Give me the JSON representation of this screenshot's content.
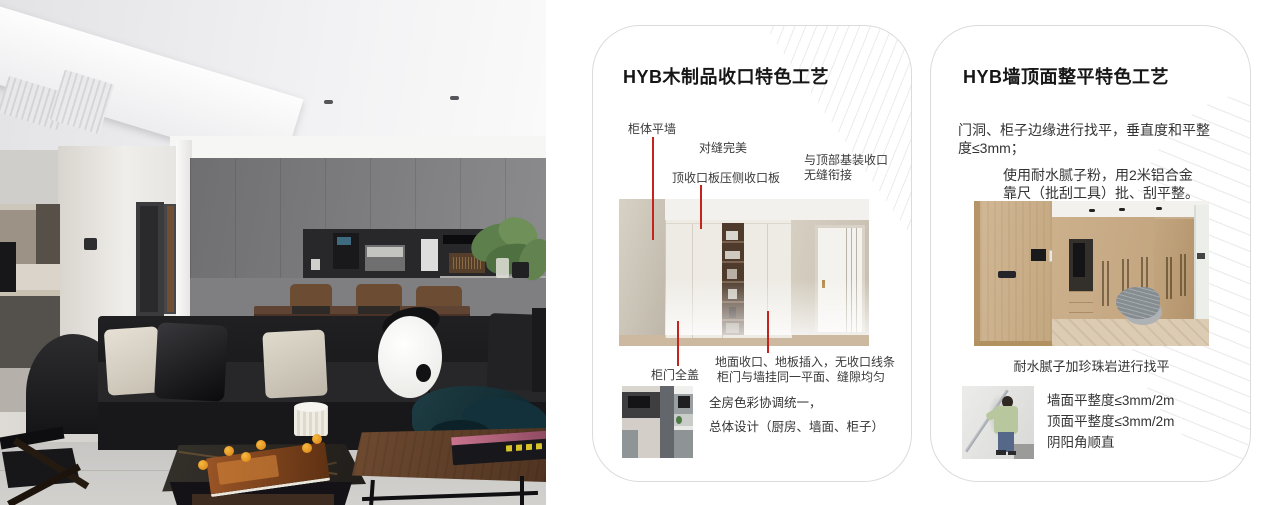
{
  "accent": {
    "callout_red": "#c5231d",
    "card_border": "#dbdbdb",
    "title_color": "#161616",
    "body_color": "#333333"
  },
  "photo": {
    "description": "modern living room: black leather sofa with panda cushion, grey panelled feature wall with coffee niche, dining table, plant, two coffee tables"
  },
  "card1": {
    "title": "HYB木制品收口特色工艺",
    "callouts": {
      "cabinet_wall": "柜体平墙",
      "seam": "对缝完美",
      "top_board": "顶收口板压侧收口板",
      "top_joint_1": "与顶部基装收口",
      "top_joint_2": "无缝衔接",
      "door_cover": "柜门全盖"
    },
    "floor_notes": [
      "地面收口、地板插入，无收口线条",
      "柜门与墙挂同一平面、缝隙均匀"
    ],
    "color_notes": [
      "全房色彩协调统一，",
      "总体设计（厨房、墙面、柜子）"
    ]
  },
  "card2": {
    "title": "HYB墙顶面整平特色工艺",
    "para1": [
      "门洞、柜子边缘进行找平，垂直度和平整",
      "度≤3mm；"
    ],
    "para2": [
      "使用耐水腻子粉，用2米铝合金",
      "靠尺（批刮工具）批、刮平整。"
    ],
    "caption": "耐水腻子加珍珠岩进行找平",
    "specs": [
      "墙面平整度≤3mm/2m",
      "顶面平整度≤3mm/2m",
      "阴阳角顺直"
    ]
  }
}
